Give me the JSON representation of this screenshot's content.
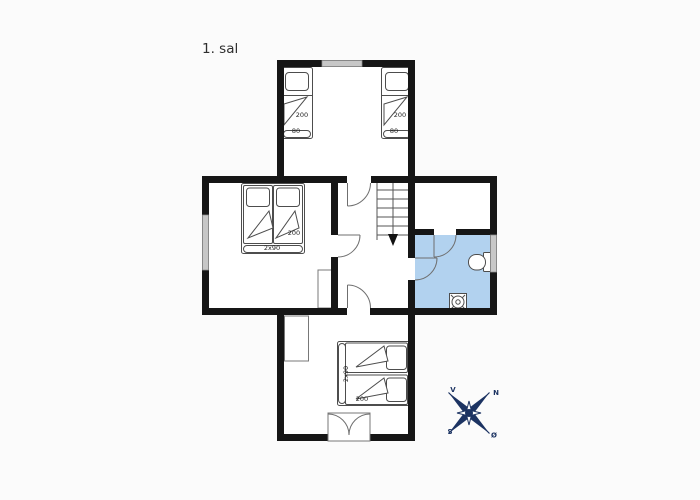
{
  "title": "1. sal",
  "colors": {
    "wall": "#161616",
    "room_fill": "#ffffff",
    "bathroom_fill": "#b2d2ef",
    "window_fill": "#c7c7c7",
    "furniture_stroke": "#4d4d4d",
    "door_stroke": "#6f6f6f",
    "compass_navy": "#1c3362",
    "background": "#fbfbfb",
    "label_color": "#222222"
  },
  "rooms": {
    "top_bedroom": {
      "bed_left": {
        "length": "200",
        "width": "80"
      },
      "bed_right": {
        "length": "200",
        "width": "80"
      }
    },
    "left_bedroom": {
      "double_bed": {
        "length": "200",
        "width": "2x90"
      }
    },
    "bottom_bedroom": {
      "double_bed": {
        "width": "2x90",
        "length": "200"
      }
    },
    "bathroom": {
      "fixture_icons": [
        "toilet-icon",
        "floor-drain-icon"
      ]
    }
  },
  "stairs": {
    "direction_icon": "arrow-down-icon"
  },
  "compass": {
    "west": "V",
    "north": "N",
    "south": "S",
    "east": "Ø"
  }
}
